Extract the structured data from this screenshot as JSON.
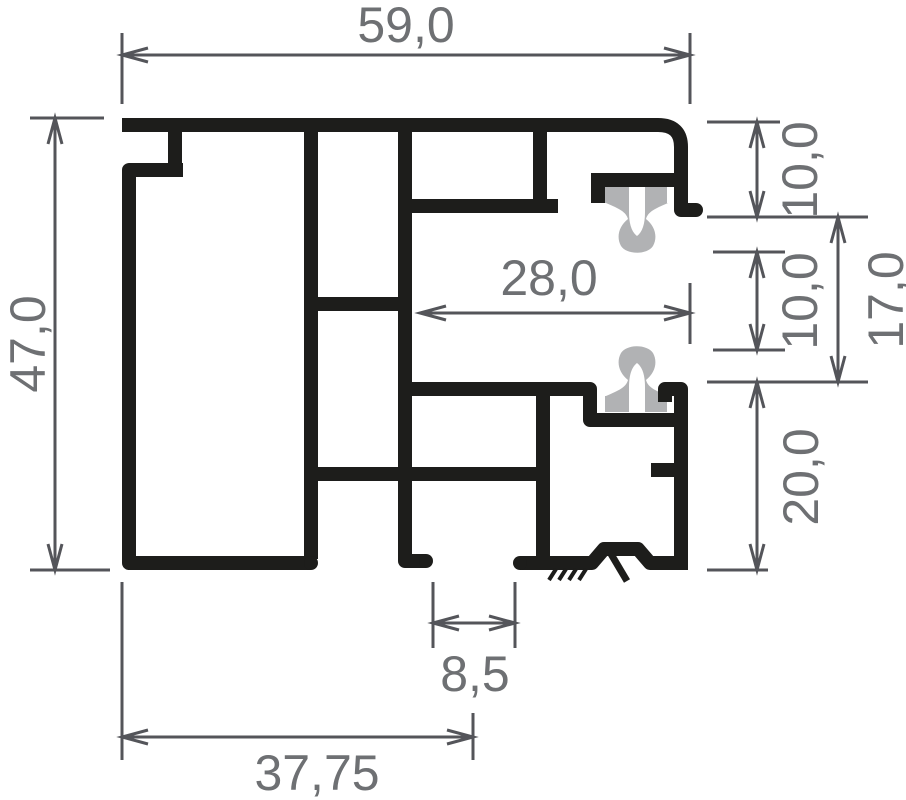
{
  "drawing": {
    "title": "aluminium-profile-cross-section",
    "type": "technical-dimension-drawing",
    "colors": {
      "background": "#ffffff",
      "profile": "#1d1d1b",
      "gasket": "#b1b2b4",
      "dimension_line": "#54555a",
      "dimension_text": "#6e7073"
    },
    "dimensions": {
      "overall_width": "59,0",
      "overall_height": "47,0",
      "rebate_height_top": "10,0",
      "gasket_gap": "10,0",
      "channel_height": "17,0",
      "channel_depth": "28,0",
      "bottom_chamber_height": "20,0",
      "bottom_slot_width": "8,5",
      "base_width": "37,75"
    }
  }
}
